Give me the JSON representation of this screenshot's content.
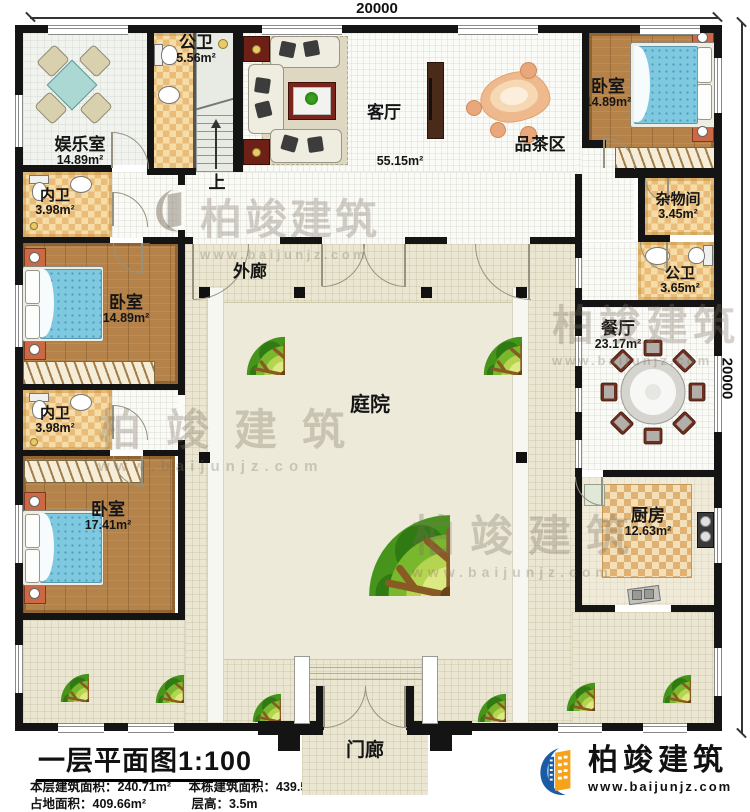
{
  "dimensions": {
    "top": "20000",
    "right": "20000"
  },
  "rooms": [
    {
      "name": "娱乐室",
      "area": "14.89m²"
    },
    {
      "name": "公卫",
      "area": "5.56m²"
    },
    {
      "name": "客厅",
      "area": "55.15m²"
    },
    {
      "name": "品茶区",
      "area": ""
    },
    {
      "name": "卧室",
      "area": "14.89m²"
    },
    {
      "name": "杂物间",
      "area": "3.45m²"
    },
    {
      "name": "公卫",
      "area": "3.65m²"
    },
    {
      "name": "餐厅",
      "area": "23.17m²"
    },
    {
      "name": "厨房",
      "area": "12.63m²"
    },
    {
      "name": "内卫",
      "area": "3.98m²"
    },
    {
      "name": "卧室",
      "area": "14.89m²"
    },
    {
      "name": "内卫",
      "area": "3.98m²"
    },
    {
      "name": "卧室",
      "area": "17.41m²"
    },
    {
      "name": "外廊",
      "area": ""
    },
    {
      "name": "庭院",
      "area": ""
    },
    {
      "name": "门廊",
      "area": ""
    }
  ],
  "stairs": {
    "label": "上"
  },
  "footer": {
    "title": "一层平面图1:100",
    "stats": [
      {
        "label": "本层建筑面积：",
        "value": "240.71m²"
      },
      {
        "label": "本栋建筑面积：",
        "value": "439.50m²"
      },
      {
        "label": "占地面积：",
        "value": "409.66m²"
      },
      {
        "label": "层高：",
        "value": "3.5m"
      }
    ],
    "brand": {
      "name": "柏竣建筑",
      "url": "www.baijunjz.com"
    }
  },
  "watermark": {
    "text": "柏竣建筑",
    "url": "www.baijunjz.com"
  },
  "colors": {
    "wall": "#141414",
    "wood": "#b5834a",
    "tile_light": "#f6dda8",
    "tile_dark": "#e9bd79",
    "courtyard": "#eae6d2",
    "bed_blue": "#7ec9e0",
    "tree_green": "#79b82c",
    "brand_blue": "#1b5aa5",
    "brand_orange": "#f6a21c"
  }
}
